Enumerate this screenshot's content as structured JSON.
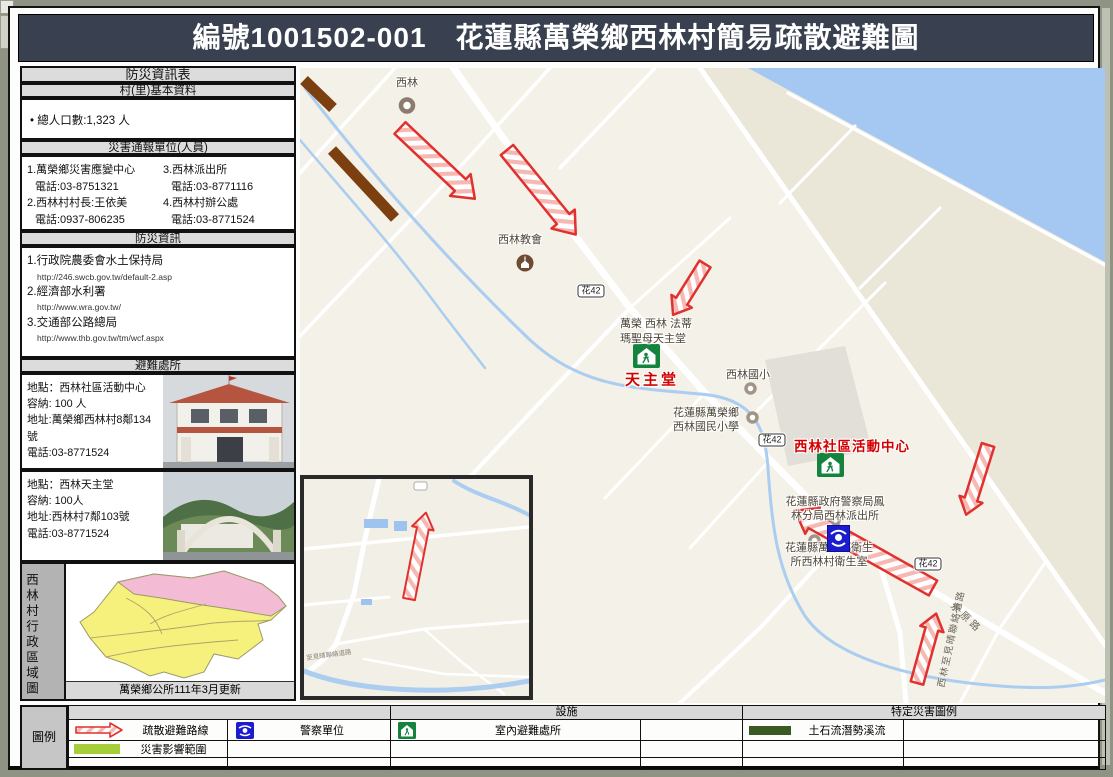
{
  "header": {
    "title": "編號1001502-001　花蓮縣萬榮鄉西林村簡易疏散避難圖"
  },
  "sidebar": {
    "info_table_title": "防災資訊表",
    "basic_title": "村(里)基本資料",
    "population": "• 總人口數:1,323  人",
    "contacts_title": "災害通報單位(人員)",
    "contacts": [
      {
        "name": "1.萬榮鄉災害應變中心",
        "phone": "電話:03-8751321"
      },
      {
        "name": "2.西林村村長:王依美",
        "phone": "電話:0937-806235"
      },
      {
        "name": "3.西林派出所",
        "phone": "電話:03-8771116"
      },
      {
        "name": "4.西林村辦公處",
        "phone": "電話:03-8771524"
      }
    ],
    "info_title": "防災資訊",
    "links": [
      {
        "name": "1.行政院農委會水土保持局",
        "url": "http://246.swcb.gov.tw/default-2.asp"
      },
      {
        "name": "2.經濟部水利署",
        "url": "http://www.wra.gov.tw/"
      },
      {
        "name": "3.交通部公路總局",
        "url": "http://www.thb.gov.tw/tm/wcf.aspx"
      }
    ],
    "shelters_title": "避難處所",
    "shelters": [
      {
        "location": "地點：西林社區活動中心",
        "capacity": "容納: 100  人",
        "address": "地址:萬榮鄉西林村8鄰134號",
        "phone": "電話:03-8771524"
      },
      {
        "location": "地點：西林天主堂",
        "capacity": "容納: 100人",
        "address": "地址:西林村7鄰103號",
        "phone": "電話:03-8771524"
      }
    ],
    "admin_map_label": "西林村行政區域圖",
    "admin_map_caption": "萬榮鄉公所111年3月更新"
  },
  "map": {
    "shield": "花42",
    "labels": {
      "village": "西林",
      "church": "西林教會",
      "cathedral_line1": "萬榮 西林 法蒂",
      "cathedral_line2": "瑪聖母天主堂",
      "cathedral_red": "天主堂",
      "school_short": "西林國小",
      "school_line1": "花蓮縣萬榮鄉",
      "school_line2": "西林國民小學",
      "community_red": "西林社區活動中心",
      "police_line1": "花蓮縣政府警察局鳳",
      "police_line2": "林分局西林派出所",
      "health_line1": "花蓮縣萬榮鄉衛生",
      "health_line2": "所西林村衛生室",
      "road_diagonal": "永原路",
      "road_vertical": "西林至見晴聯絡道路",
      "inset_road": "至見晴聯絡道路"
    }
  },
  "legend": {
    "title": "圖例",
    "facilities_header": "設施",
    "hazard_header": "特定災害圖例",
    "route_label": "疏散避難路線",
    "impact_label": "災害影響範圍",
    "police_label": "警察單位",
    "shelter_label": "室內避難處所",
    "debris_label": "土石流潛勢溪流"
  },
  "colors": {
    "titlebar_bg": "#394150",
    "arrow_red": "#e0312e",
    "impact_green": "#a6ce39",
    "debris_green": "#3a5a22",
    "police_blue": "#1c1ccf",
    "shelter_green": "#13833e",
    "water_blue": "#a4c8f2",
    "hazard_brown": "#7b3f10",
    "red_label": "#d40000"
  }
}
